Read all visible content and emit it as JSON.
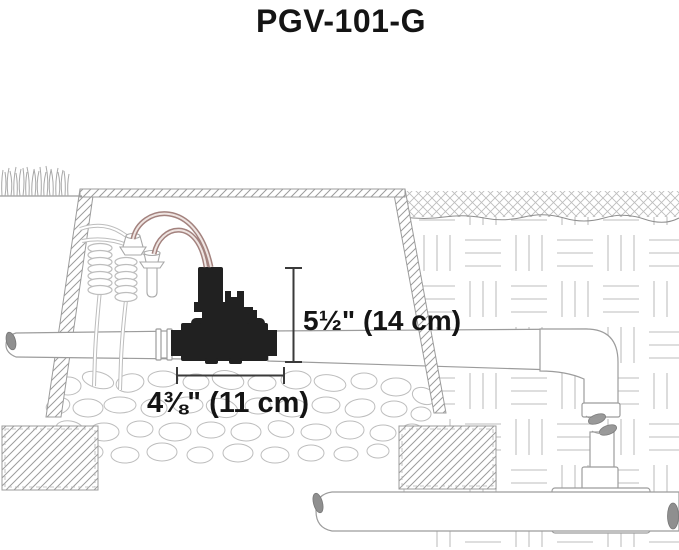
{
  "title": "PGV-101-G",
  "annotations": {
    "height_label": "5½\" (14 cm)",
    "width_label": "4⅜\" (11 cm)"
  },
  "colors": {
    "text": "#141414",
    "dimension_line": "#3a3a3a",
    "line": "#9c9c9c",
    "soil_pattern": "#c9c9c9",
    "wire": "#a3827e",
    "valve_body": "#212121",
    "pipe_cap": "#8f8f8f"
  }
}
